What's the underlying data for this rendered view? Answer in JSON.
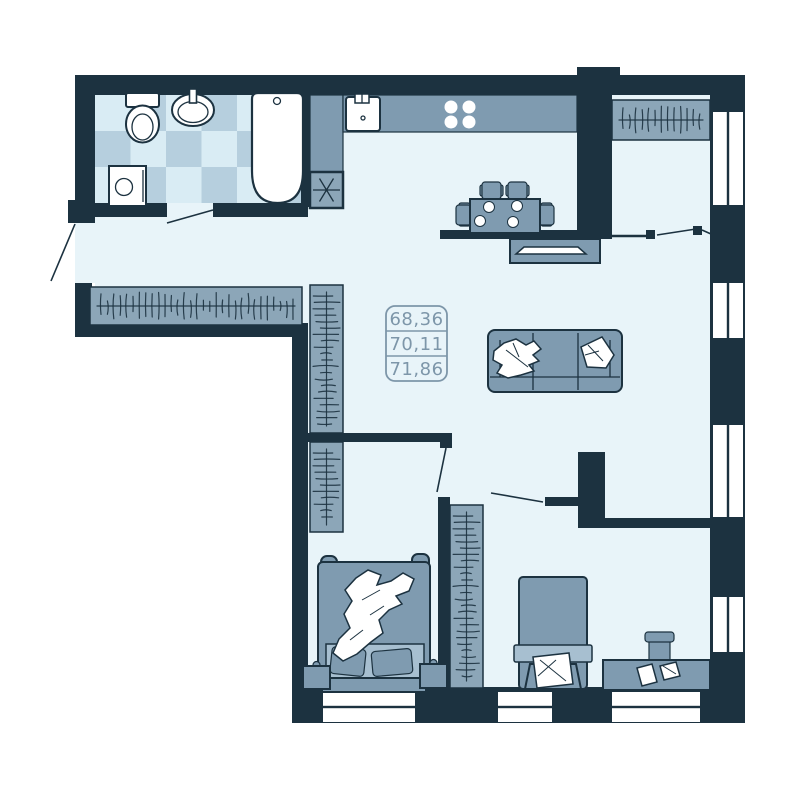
{
  "floor_plan": {
    "area_label": {
      "values": [
        "68,36",
        "70,11",
        "71,86"
      ]
    },
    "shaft_symbol": "✳",
    "colors": {
      "wall": "#1c3240",
      "floor": "#e8f4f9",
      "furniture": "#7f9bb0",
      "wardrobe": "#8ca6b8",
      "bed_linen": "#a7bfd0",
      "tile_light": "#d9ecf4",
      "tile_dark": "#b6cfde",
      "fixture_white": "#ffffff",
      "label_text": "#7d96a9"
    }
  }
}
